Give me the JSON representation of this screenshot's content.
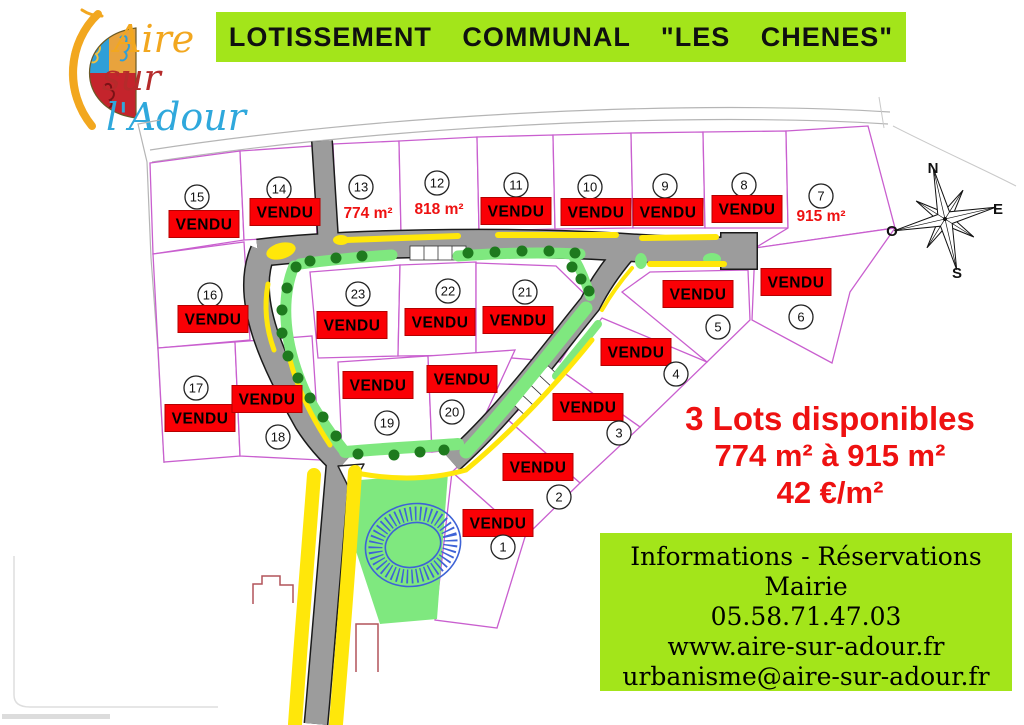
{
  "header": {
    "title": "LOTISSEMENT COMMUNAL \"LES CHENES\""
  },
  "logo": {
    "word1": "Aire",
    "word2": "sur",
    "word3": "l'Adour"
  },
  "compass": {
    "n": "N",
    "e": "E",
    "s": "S",
    "o": "O"
  },
  "lots": [
    {
      "number": "1",
      "status": "VENDU"
    },
    {
      "number": "2",
      "status": "VENDU"
    },
    {
      "number": "3",
      "status": "VENDU"
    },
    {
      "number": "4",
      "status": "VENDU"
    },
    {
      "number": "5",
      "status": "VENDU"
    },
    {
      "number": "6",
      "status": "VENDU"
    },
    {
      "number": "7",
      "status": "915 m²"
    },
    {
      "number": "8",
      "status": "VENDU"
    },
    {
      "number": "9",
      "status": "VENDU"
    },
    {
      "number": "10",
      "status": "VENDU"
    },
    {
      "number": "11",
      "status": "VENDU"
    },
    {
      "number": "12",
      "status": "818 m²"
    },
    {
      "number": "13",
      "status": "774 m²"
    },
    {
      "number": "14",
      "status": "VENDU"
    },
    {
      "number": "15",
      "status": "VENDU"
    },
    {
      "number": "16",
      "status": "VENDU"
    },
    {
      "number": "17",
      "status": "VENDU"
    },
    {
      "number": "18",
      "status": "VENDU"
    },
    {
      "number": "19",
      "status": "VENDU"
    },
    {
      "number": "20",
      "status": "VENDU"
    },
    {
      "number": "21",
      "status": "VENDU"
    },
    {
      "number": "22",
      "status": "VENDU"
    },
    {
      "number": "23",
      "status": "VENDU"
    }
  ],
  "availability": {
    "line1": "3 Lots disponibles",
    "line2": "774 m² à 915 m²",
    "line3": "42 €/m²"
  },
  "info": {
    "line1": "Informations - Réservations",
    "line2": "Mairie",
    "phone": "05.58.71.47.03",
    "website": "www.aire-sur-adour.fr",
    "email": "urbanisme@aire-sur-adour.fr"
  },
  "colors": {
    "banner_green": "#A3E51A",
    "lot_border": "#C95FCF",
    "sold_red": "#FA0005",
    "accent_red": "#EE1111",
    "road_gray": "#9C9C9C",
    "verge_green": "#7FE87F",
    "tree_green": "#1E7A1E",
    "marking_yellow": "#FFE70A",
    "basin_blue": "#3E63D6"
  }
}
